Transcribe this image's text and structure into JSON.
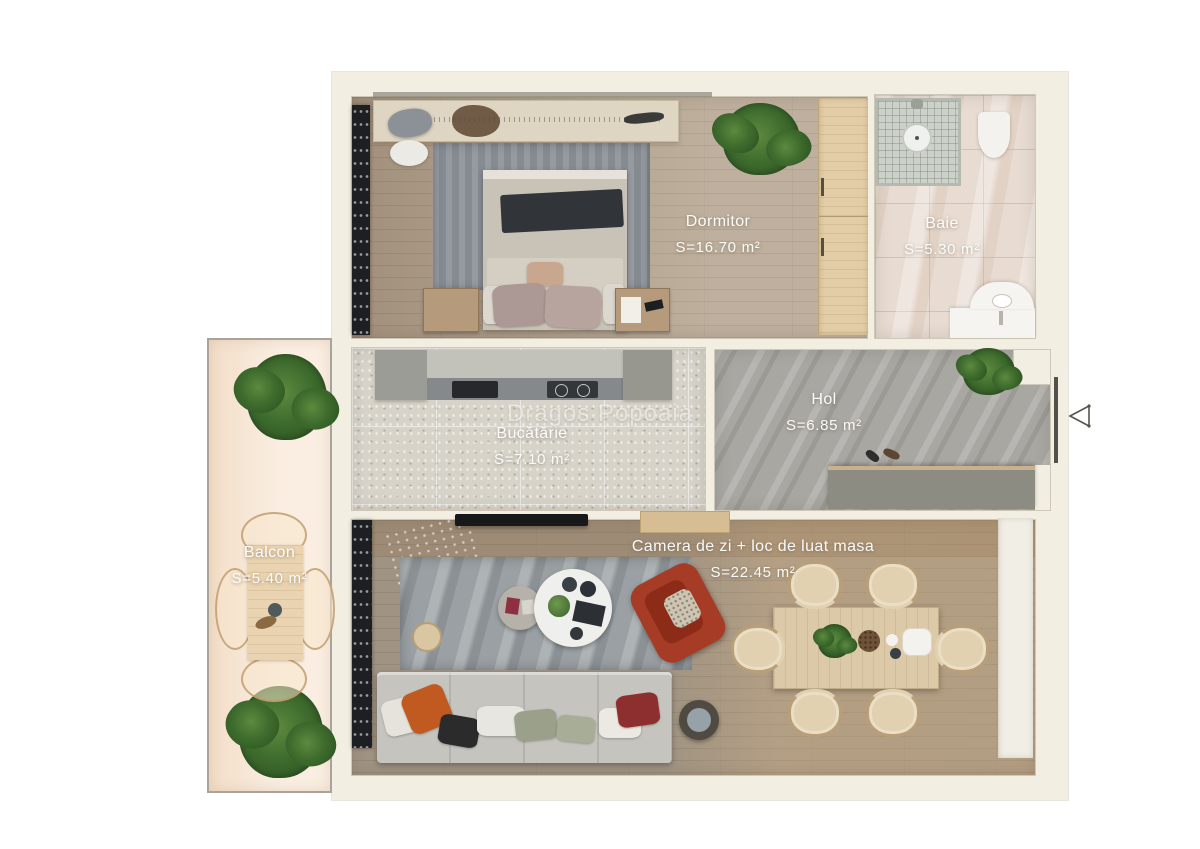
{
  "watermark": "Dragos Popoaia",
  "rooms": [
    {
      "name": "Dormitor",
      "area": "S=16.70  m²"
    },
    {
      "name": "Baie",
      "area": "S=5.30  m²"
    },
    {
      "name": "Bucătărie",
      "area": "S=7.10  m²"
    },
    {
      "name": "Hol",
      "area": "S=6.85  m²"
    },
    {
      "name": "Camera de zi + loc de luat masa",
      "area": "S=22.45  m²"
    },
    {
      "name": "Balcon",
      "area": "S=5.40  m²"
    }
  ],
  "entrance": {
    "icon": "triangle-left-entrance-marker"
  },
  "colors": {
    "background": "#ffffff",
    "wall": "#f3eee2",
    "bedroom_floor": "#b2a08b",
    "bath_floor": "#e8dcd2",
    "kitchen_floor": "#d7d3c9",
    "hall_floor": "#a8a7a2",
    "living_floor": "#a99d8c",
    "balcony_floor": "#f8e9d8",
    "armchair_accent": "#a63c25",
    "pillow_accent": "#c05a20"
  }
}
